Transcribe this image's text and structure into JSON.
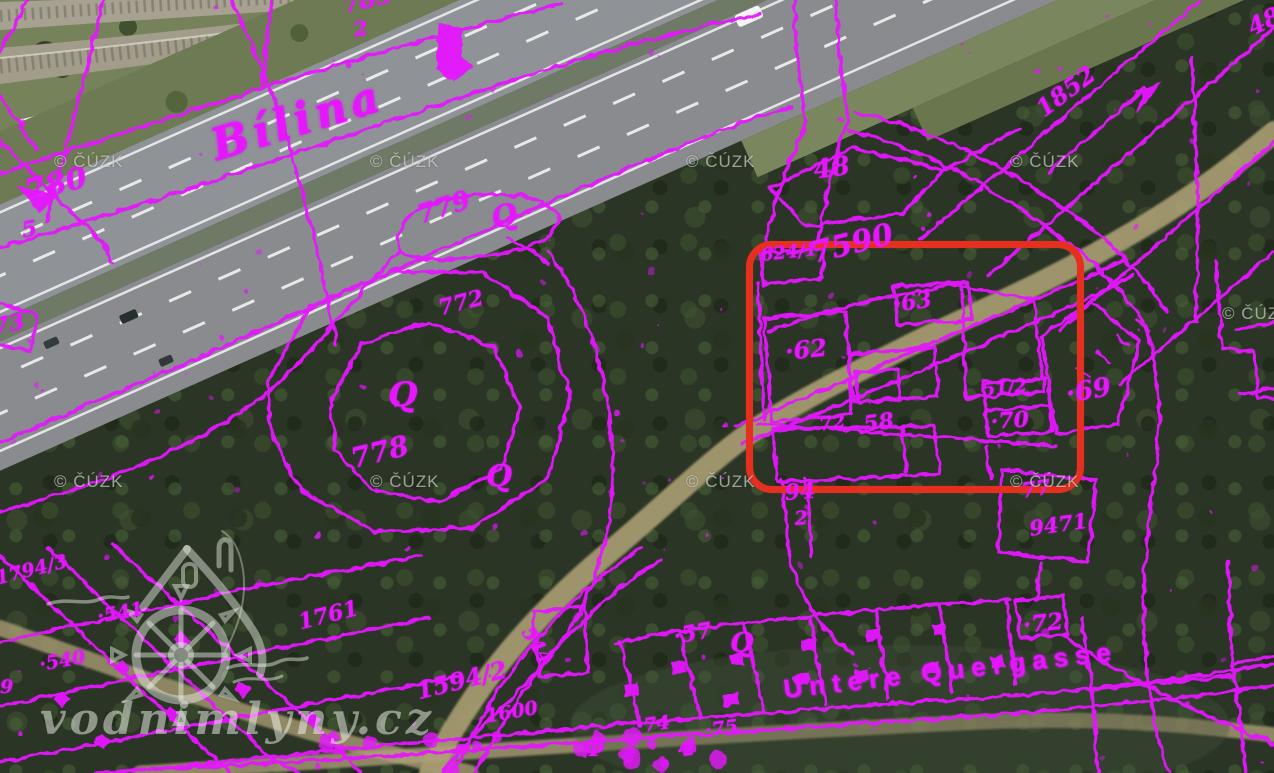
{
  "branding": {
    "site_watermark": "vodnimlyny.cz",
    "map_copyright": "© ČÚZK"
  },
  "map": {
    "colors": {
      "cadastral": "#e616ff",
      "highlight": "#e6301f",
      "aerial_road": "#8f9296",
      "dirt_road": "#b3a478"
    },
    "highlight_box": {
      "x": 746,
      "y": 241,
      "width": 324,
      "height": 238
    },
    "waterway_label": "Bílina",
    "street_label": "Untere Quergasse",
    "labels": [
      {
        "text": "Bílina",
        "x": 206,
        "y": 126,
        "rot": -17,
        "size": 44,
        "cls": "big"
      },
      {
        "text": "Untere Quergasse",
        "x": 782,
        "y": 676,
        "rot": -6.5,
        "size": 26,
        "cls": "street"
      },
      {
        "text": "780",
        "x": 22,
        "y": 178,
        "rot": -14,
        "size": 30
      },
      {
        "text": "5",
        "x": 20,
        "y": 220,
        "rot": -10,
        "size": 22
      },
      {
        "text": "73",
        "x": -8,
        "y": 316,
        "rot": -10,
        "size": 22
      },
      {
        "text": "783",
        "x": 340,
        "y": -6,
        "rot": -14,
        "size": 24
      },
      {
        "text": "2",
        "x": 352,
        "y": 20,
        "rot": -10,
        "size": 20
      },
      {
        "text": "779",
        "x": 414,
        "y": 204,
        "rot": -18,
        "size": 26
      },
      {
        "text": "772",
        "x": 436,
        "y": 298,
        "rot": -14,
        "size": 22
      },
      {
        "text": "778",
        "x": 348,
        "y": 446,
        "rot": -14,
        "size": 28
      },
      {
        "text": "48",
        "x": 812,
        "y": 158,
        "rot": -8,
        "size": 26
      },
      {
        "text": "48",
        "x": 1244,
        "y": 18,
        "rot": -26,
        "size": 24
      },
      {
        "text": "1852",
        "x": 1032,
        "y": 102,
        "rot": -37,
        "size": 24
      },
      {
        "text": "624/1",
        "x": 760,
        "y": 247,
        "rot": -6,
        "size": 18
      },
      {
        "text": "7590",
        "x": 808,
        "y": 240,
        "rot": -14,
        "size": 30
      },
      {
        "text": "·63",
        "x": 892,
        "y": 294,
        "rot": -8,
        "size": 22
      },
      {
        "text": "·62",
        "x": 784,
        "y": 340,
        "rot": -6,
        "size": 24
      },
      {
        "text": "72",
        "x": 818,
        "y": 416,
        "rot": -8,
        "size": 19
      },
      {
        "text": "58",
        "x": 862,
        "y": 414,
        "rot": -8,
        "size": 22
      },
      {
        "text": "51/2",
        "x": 982,
        "y": 382,
        "rot": -6,
        "size": 18
      },
      {
        "text": "·70",
        "x": 990,
        "y": 411,
        "rot": -4,
        "size": 22
      },
      {
        "text": "·69",
        "x": 1064,
        "y": 382,
        "rot": -10,
        "size": 26
      },
      {
        "text": "94",
        "x": 784,
        "y": 482,
        "rot": -4,
        "size": 22
      },
      {
        "text": "2",
        "x": 794,
        "y": 510,
        "rot": -4,
        "size": 19
      },
      {
        "text": "77",
        "x": 1020,
        "y": 480,
        "rot": -8,
        "size": 21
      },
      {
        "text": "9471",
        "x": 1028,
        "y": 518,
        "rot": -8,
        "size": 21
      },
      {
        "text": "·72",
        "x": 1022,
        "y": 614,
        "rot": -6,
        "size": 23
      },
      {
        "text": "1794/3",
        "x": -6,
        "y": 570,
        "rot": -14,
        "size": 19
      },
      {
        "text": "·541",
        "x": 96,
        "y": 608,
        "rot": -10,
        "size": 19
      },
      {
        "text": "·540",
        "x": 38,
        "y": 656,
        "rot": -10,
        "size": 19
      },
      {
        "text": "9",
        "x": 0,
        "y": 678,
        "rot": 0,
        "size": 19
      },
      {
        "text": "1761",
        "x": 296,
        "y": 612,
        "rot": -14,
        "size": 22
      },
      {
        "text": "1594/2",
        "x": 414,
        "y": 680,
        "rot": -14,
        "size": 24
      },
      {
        "text": "1600",
        "x": 484,
        "y": 708,
        "rot": -10,
        "size": 19
      },
      {
        "text": "544",
        "x": 534,
        "y": 624,
        "rot": 58,
        "size": 19
      },
      {
        "text": "·57",
        "x": 672,
        "y": 626,
        "rot": -10,
        "size": 22
      },
      {
        "text": "·74",
        "x": 636,
        "y": 718,
        "rot": -8,
        "size": 19
      },
      {
        "text": "·75",
        "x": 704,
        "y": 722,
        "rot": -8,
        "size": 19
      },
      {
        "text": "·2",
        "x": 676,
        "y": 744,
        "rot": -8,
        "size": 17
      },
      {
        "text": "Q",
        "x": 488,
        "y": 206,
        "rot": -15,
        "size": 30,
        "cls": "sym"
      },
      {
        "text": "Q",
        "x": 388,
        "y": 378,
        "rot": 0,
        "size": 34,
        "cls": "sym"
      },
      {
        "text": "Q",
        "x": 486,
        "y": 462,
        "rot": 0,
        "size": 30,
        "cls": "sym"
      },
      {
        "text": "Q",
        "x": 730,
        "y": 630,
        "rot": 0,
        "size": 27,
        "cls": "sym"
      },
      {
        "text": "Φ",
        "x": 584,
        "y": 736,
        "rot": 0,
        "size": 24,
        "cls": "sym"
      }
    ],
    "copyright_marks": [
      {
        "x": 54,
        "y": 152
      },
      {
        "x": 370,
        "y": 152
      },
      {
        "x": 686,
        "y": 152
      },
      {
        "x": 1010,
        "y": 152
      },
      {
        "x": 1222,
        "y": 304
      },
      {
        "x": 54,
        "y": 472
      },
      {
        "x": 370,
        "y": 472
      },
      {
        "x": 686,
        "y": 472
      },
      {
        "x": 1010,
        "y": 472
      }
    ]
  }
}
